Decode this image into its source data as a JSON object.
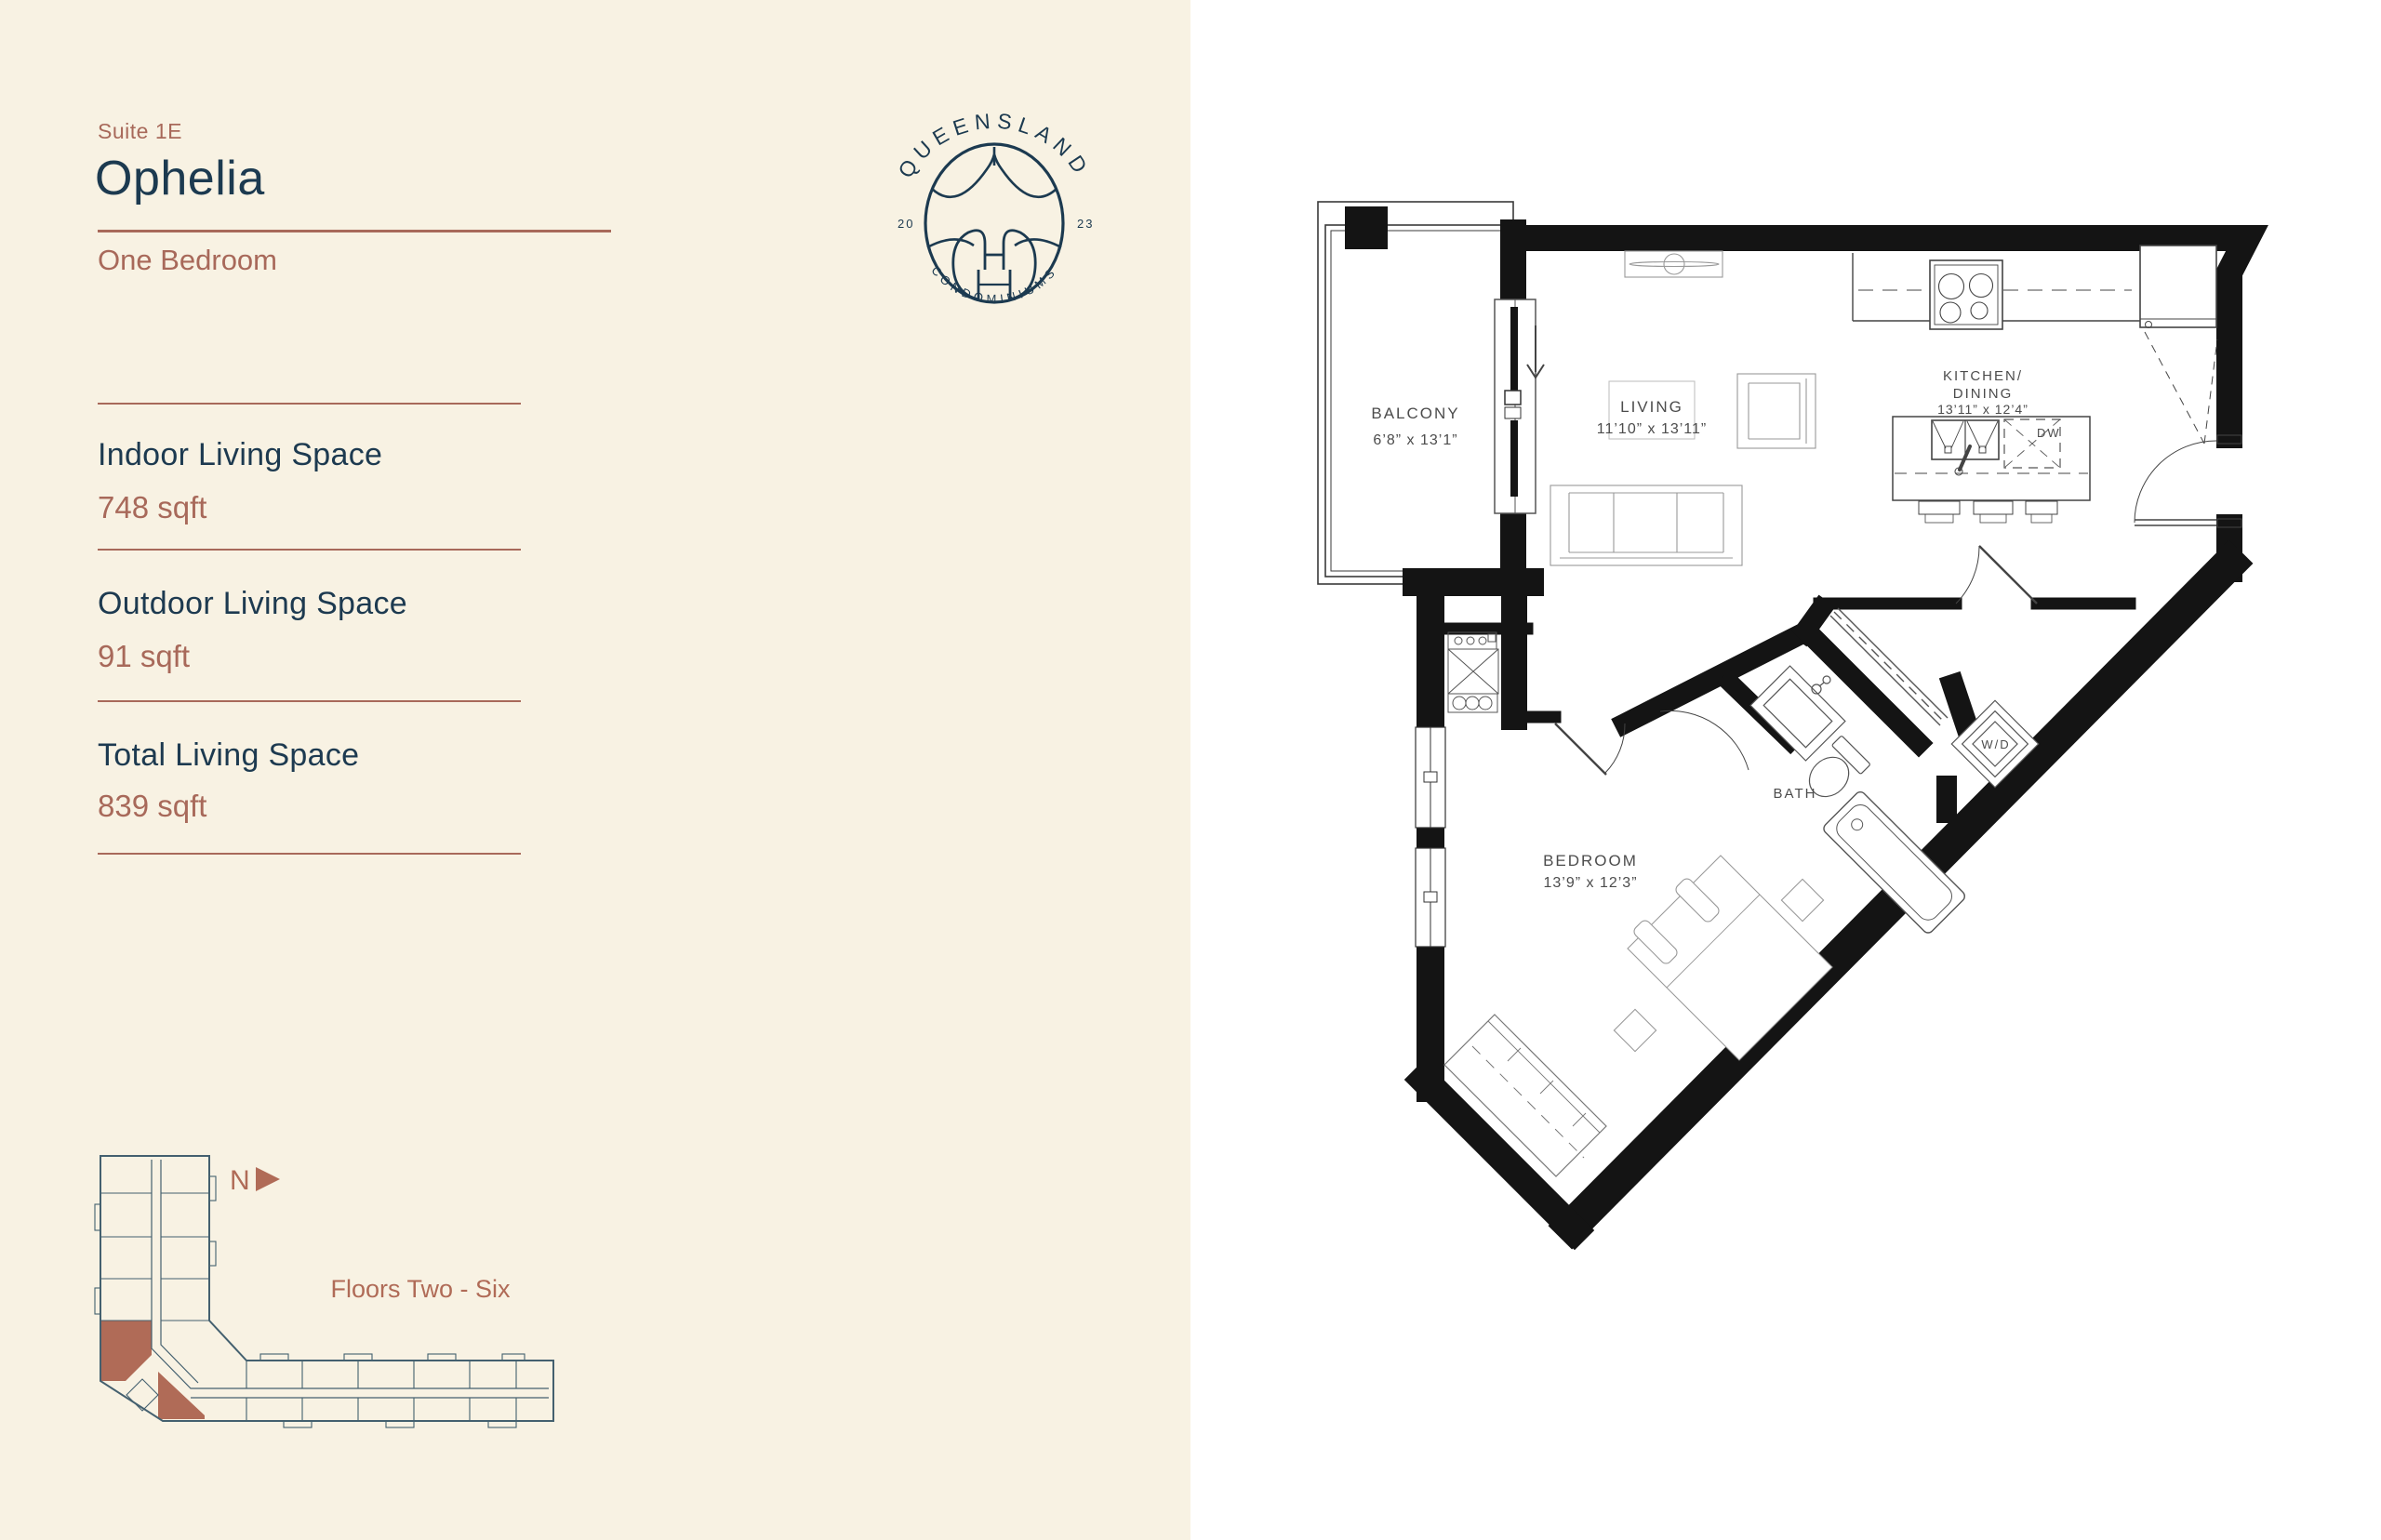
{
  "header": {
    "suite_label": "Suite 1E",
    "suite_name": "Ophelia",
    "suite_type": "One Bedroom"
  },
  "stats": [
    {
      "label": "Indoor Living Space",
      "value": "748 sqft"
    },
    {
      "label": "Outdoor Living Space",
      "value": "91 sqft"
    },
    {
      "label": "Total Living Space",
      "value": "839 sqft"
    }
  ],
  "logo": {
    "arc_top": "QUEENSLAND",
    "arc_bottom": "CONDOMINIUMS",
    "year_left": "20",
    "year_right": "23"
  },
  "keyplan": {
    "north_label": "N",
    "floors_label": "Floors Two - Six"
  },
  "plan": {
    "balcony": {
      "name": "BALCONY",
      "dims": "6’8” x 13’1”"
    },
    "living": {
      "name": "LIVING",
      "dims": "11’10” x 13’11”"
    },
    "kitchen": {
      "name_line1": "KITCHEN/",
      "name_line2": "DINING",
      "dims": "13’11” x 12’4”"
    },
    "bath": {
      "name": "BATH"
    },
    "laundry": {
      "name": "W/D"
    },
    "dishwasher": {
      "name": "DW"
    },
    "bedroom": {
      "name": "BEDROOM",
      "dims": "13’9” x 12’3”"
    }
  },
  "note": "Note: The floor plans and elevations shown are pre-construction plans and may be revised or improved as necessitated by architectural controls and the construction process.   The measurements adhere to the rules and regulations of the Ontario New Home Warranty Program’s official method for the calculation of the floor area.  The actual usable space may vary from the stated floor area.  Sizes and specifications are subject to change without notice.  All dimensions are subject to normal construction variances.  All floor plans and renderings are artist’s concept only.",
  "colors": {
    "cream_bg": "#f8f2e3",
    "navy": "#1c3a50",
    "terracotta": "#a8695a",
    "note_rose": "#ad7e71",
    "keyplan_slate": "#44606f",
    "keyplan_highlight": "#b06b57",
    "wall_black": "#141414"
  }
}
